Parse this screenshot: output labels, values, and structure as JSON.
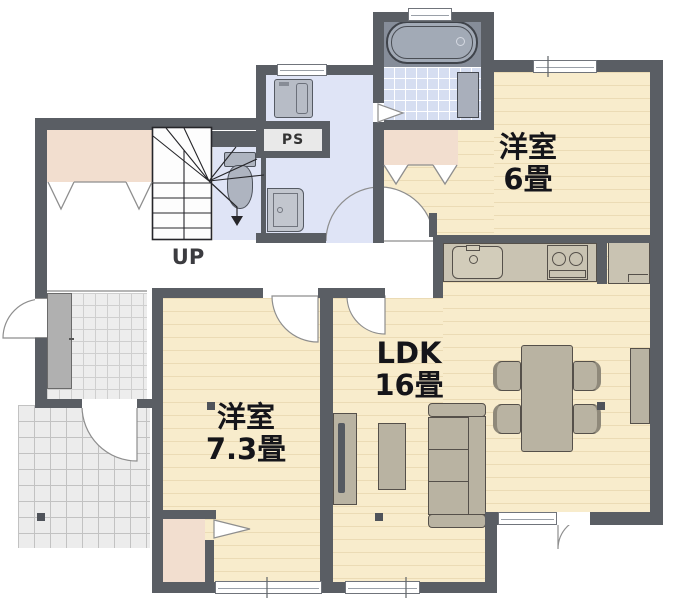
{
  "plan_title": "1F floor plan",
  "rooms": {
    "western6": {
      "line1": "洋室",
      "line2": "6畳"
    },
    "ldk": {
      "line1": "LDK",
      "line2": "16畳"
    },
    "western73": {
      "line1": "洋室",
      "line2": "7.3畳"
    }
  },
  "labels": {
    "stairs_direction": "UP",
    "pipe_space": "PS"
  },
  "colors": {
    "wall": "#5a5e64",
    "room_floor": "#f8eccc",
    "closet": "#f2decf",
    "wet_area_floor": "#dfe4f6",
    "bath_tile": "#d6def1",
    "entrance_tile": "#ededed",
    "furniture": "#b9b3a2",
    "kitchen_counter": "#c9c3b2",
    "bathtub": "#a2aab6"
  },
  "fixtures": [
    "bathtub",
    "bath-counter",
    "washing-machine",
    "vanity",
    "toilet",
    "stairs",
    "pipe-space",
    "kitchen-sink",
    "stove",
    "refrigerator",
    "dining-table",
    "dining-chair",
    "sofa",
    "coffee-table",
    "tv-board",
    "tv",
    "sideboard",
    "shoe-cabinet",
    "entrance-porch"
  ]
}
